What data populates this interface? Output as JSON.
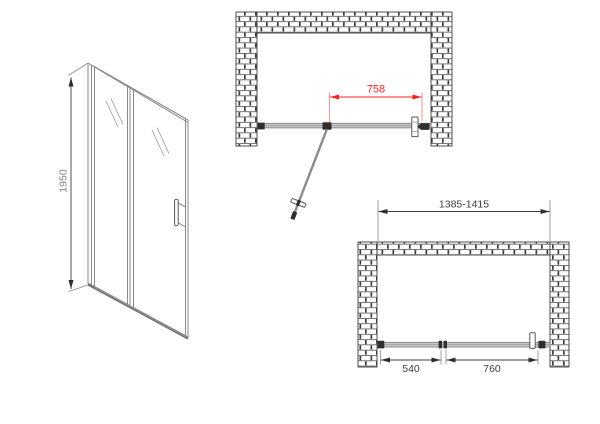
{
  "colors": {
    "background": "#ffffff",
    "line_gray": "#8a8a8a",
    "fitting_dark": "#2e2e2e",
    "brick_outline": "#3d3d3d",
    "dimension_text": "#3d3d3d",
    "dimension_red": "#f52020"
  },
  "perspective_view": {
    "height_label": "1950"
  },
  "top_plan_view": {
    "width_label": "758"
  },
  "front_plan_view": {
    "opening_label": "1385-1415",
    "left_label": "540",
    "right_label": "760"
  }
}
